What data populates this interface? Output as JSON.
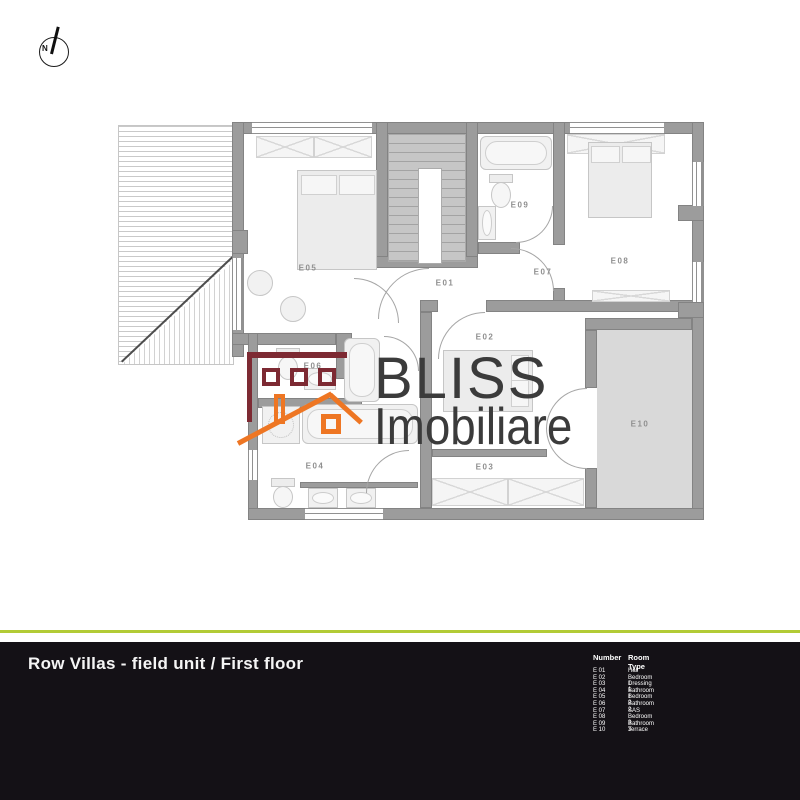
{
  "compass": {
    "label": "N"
  },
  "watermark": {
    "line1": "BLISS",
    "line2": "Imobiliare"
  },
  "colors": {
    "accent_green": "#b2cb35",
    "footer_bg": "#141116",
    "logo_dark_red": "#7d2a33",
    "logo_orange": "#ee7623",
    "wall_gray": "#9c9c9c",
    "terrace_fill": "#d9d9d9"
  },
  "plan": {
    "rooms": [
      {
        "id": "E01",
        "name": "Hall"
      },
      {
        "id": "E02",
        "name": "Bedroom 1"
      },
      {
        "id": "E03",
        "name": "Dressing 1"
      },
      {
        "id": "E04",
        "name": "Bathroom 1"
      },
      {
        "id": "E05",
        "name": "Bedroom 2"
      },
      {
        "id": "E06",
        "name": "Bathroom 2"
      },
      {
        "id": "E07",
        "name": "SAS"
      },
      {
        "id": "E08",
        "name": "Bedroom 3"
      },
      {
        "id": "E09",
        "name": "Bathroom 3"
      },
      {
        "id": "E10",
        "name": "Terrace"
      }
    ]
  },
  "footer": {
    "title": "Row Villas - field unit / First floor"
  },
  "legend": {
    "header": {
      "number": "Number",
      "room_type": "Room Type"
    },
    "rows": [
      {
        "num": "E 01",
        "type": "Hall"
      },
      {
        "num": "E 02",
        "type": "Bedroom 1"
      },
      {
        "num": "E 03",
        "type": "Dressing 1"
      },
      {
        "num": "E 04",
        "type": "Bathroom 1"
      },
      {
        "num": "E 05",
        "type": "Bedroom 2"
      },
      {
        "num": "E 06",
        "type": "Bathroom 2"
      },
      {
        "num": "E 07",
        "type": "SAS"
      },
      {
        "num": "E 08",
        "type": "Bedroom 3"
      },
      {
        "num": "E 09",
        "type": "Bathroom 3"
      },
      {
        "num": "E 10",
        "type": "Terrace"
      }
    ]
  }
}
